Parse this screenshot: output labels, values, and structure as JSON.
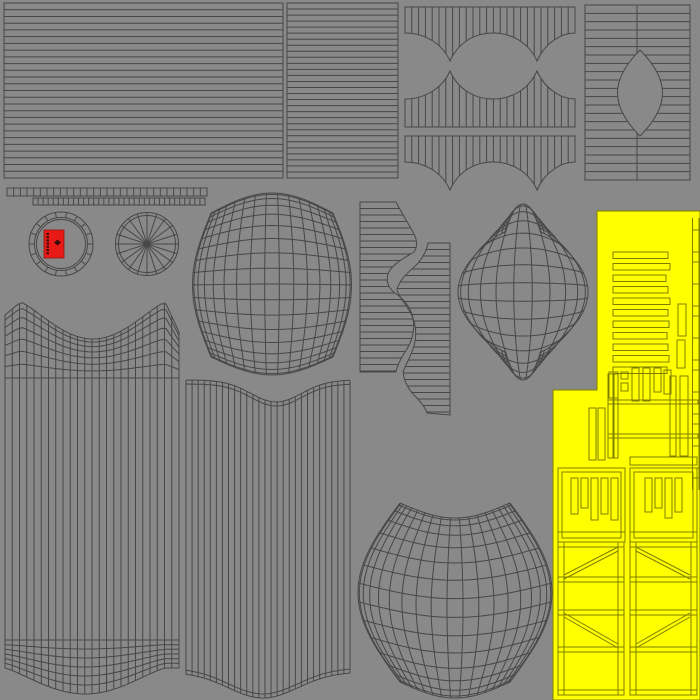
{
  "canvas": {
    "width": 700,
    "height": 700,
    "background": "#898989"
  },
  "palette": {
    "wire": "#474747",
    "yellow": "#ffff00",
    "yellow_wire": "#7f7f00",
    "red": "#e81a17",
    "red_dark": "#3a0b0b"
  },
  "red_label": {
    "x": 44,
    "y": 230,
    "w": 20,
    "h": 28,
    "dots": 7,
    "dot_x": 46.5,
    "dot_y0": 233,
    "dot_step": 3.2,
    "glyph_cx": 57.5,
    "glyph_cy": 242.5
  },
  "islands": [
    {
      "name": "panel-top-left-hlines",
      "kind": "hrect",
      "x": 4,
      "y": 3,
      "w": 279,
      "h": 175,
      "lines": 26
    },
    {
      "name": "panel-top-mid-hlines",
      "kind": "hrect",
      "x": 287,
      "y": 3,
      "w": 111,
      "h": 175,
      "lines": 29
    },
    {
      "name": "band-top",
      "kind": "path_hatch",
      "hatch": "v",
      "spacing": 6.8,
      "path": "M405,7 H575 V33 C561,33 545,43 537,61 C529,43 512,33 493,33 C474,33 458,43 450,61 C442,43 424,33 405,33 Z"
    },
    {
      "name": "band-middle",
      "kind": "path_hatch",
      "hatch": "v",
      "spacing": 6.8,
      "path": "M405,99 C424,99 442,89 450,71 C458,89 474,99 493,99 C512,99 529,89 537,71 C545,89 561,99 575,99 V127 H405 Z"
    },
    {
      "name": "band-bottom",
      "kind": "path_hatch",
      "hatch": "v",
      "spacing": 6.8,
      "path": "M405,136 H575 V162 C561,162 545,172 537,190 C529,172 512,162 493,162 C474,162 458,172 450,190 C442,172 424,162 405,162 Z"
    },
    {
      "name": "panel-top-right-lens",
      "kind": "hrect_hole",
      "x": 585,
      "y": 5,
      "w": 105,
      "h": 175,
      "lines": 21,
      "centerX": 637,
      "hole": {
        "cx": 640,
        "cy": 93,
        "rx": 30,
        "ry": 43
      }
    },
    {
      "name": "tick-strip-long",
      "kind": "tick_strip",
      "x": 7,
      "y": 188,
      "w": 200,
      "h": 8,
      "ticks": 30
    },
    {
      "name": "tick-strip-short",
      "kind": "tick_strip",
      "x": 33,
      "y": 198,
      "w": 172,
      "h": 7,
      "ticks": 34
    },
    {
      "name": "ring-island",
      "kind": "ring",
      "cx": 61,
      "cy": 244,
      "rOuter": 32,
      "rInner": 26.5,
      "segments": 18
    },
    {
      "name": "spoke-wheel-island",
      "kind": "wheel",
      "cx": 147,
      "cy": 244,
      "rOuter": 31.5,
      "rRim": 28.5,
      "spokes": 20
    },
    {
      "name": "barrel-grid",
      "kind": "pillow_grid",
      "cx": 272,
      "wEnd": 122,
      "wMid": 159,
      "yTop": 213,
      "yTopBulge": -20,
      "yBot": 357,
      "yBotBulge": 18,
      "cols": 17,
      "rows": 18,
      "wPow": 1,
      "yPow": 1
    },
    {
      "name": "zigzag-left",
      "kind": "path_hatch",
      "hatch": "h",
      "spacing": 6.5,
      "path": "M360,202 H396 C402,214 410,226 414,234 C417,240 418,246 414,252 C404,258 392,264 388,274 C386,281 388,288 395,293 C404,299 411,308 413,318 C415,330 412,342 405,352 C400,360 397,366 396,372 H360 Z"
    },
    {
      "name": "zigzag-right",
      "kind": "path_hatch",
      "hatch": "h",
      "spacing": 6.5,
      "path": "M428,243 C426,254 420,262 412,269 C404,276 398,283 397,290 C399,297 405,303 410,312 C416,322 417,334 414,346 C411,356 406,364 403,372 C404,381 408,389 415,396 C421,402 425,407 427,413 L450,415 V243 Z"
    },
    {
      "name": "pod-grid",
      "kind": "pillow_grid",
      "cx": 523,
      "wEnd": 36,
      "wMid": 130,
      "yTop": 232,
      "yTopBulge": -28,
      "yBot": 352,
      "yBotBulge": 28,
      "cols": 11,
      "rows": 15,
      "wPow": 0.8,
      "yPow": 0.7
    },
    {
      "name": "bowtie-skirt",
      "kind": "bowtie_skirt",
      "x0": 5,
      "x1": 179,
      "cols": 24,
      "peakY": 302,
      "dipAmp": 37,
      "midY": 378,
      "stripeEndY": 640,
      "botBase": 668,
      "botAmp": 26,
      "topRows": 7,
      "botRows": 6
    },
    {
      "name": "ribbon-band",
      "kind": "ribbon",
      "x0": 186,
      "x1": 350,
      "cols": 27,
      "topBase": 380,
      "topAmp": 22,
      "topCenter": 0.55,
      "topWidth": 0.22,
      "botBase": 672,
      "botAmp": 26,
      "botCenter": 0.47,
      "botWidth": 0.3
    },
    {
      "name": "pillow-grid",
      "kind": "pillow_grid",
      "cx": 455,
      "wEnd": 110,
      "wMid": 194,
      "yTop": 503,
      "yTopBulge": 15,
      "yBot": 682,
      "yBotBulge": 16,
      "cols": 19,
      "rows": 15,
      "wPow": 1,
      "yPow": 1
    }
  ],
  "yellow_region": {
    "name": "yellow-uv-sheet",
    "outline": "M597,211 H700 V700 H553 V390 H597 Z",
    "bars": [
      [
        613,
        252,
        55,
        6.5
      ],
      [
        613,
        263.5,
        57,
        6.5
      ],
      [
        613,
        275,
        53,
        6.5
      ],
      [
        613,
        286.5,
        55,
        6.5
      ],
      [
        613,
        298,
        57,
        6.5
      ],
      [
        613,
        309.5,
        55,
        6.5
      ],
      [
        613,
        321,
        56,
        6.5
      ],
      [
        613,
        332.5,
        54,
        6.5
      ],
      [
        613,
        344,
        55,
        6.5
      ],
      [
        613,
        355.5,
        56,
        6.5
      ],
      [
        613,
        367,
        54,
        6.5
      ]
    ],
    "rects": [
      [
        678,
        304,
        8,
        32
      ],
      [
        677,
        340,
        8,
        28
      ],
      [
        609,
        372,
        9,
        26
      ],
      [
        621,
        372,
        7,
        7
      ],
      [
        621,
        383,
        7,
        8
      ],
      [
        632,
        368,
        7,
        33
      ],
      [
        643,
        368,
        7,
        33
      ],
      [
        654,
        368,
        7,
        24
      ],
      [
        664,
        370,
        7,
        24
      ],
      [
        608,
        400,
        90,
        4
      ],
      [
        608,
        434,
        90,
        4
      ],
      [
        589,
        408,
        7,
        52
      ],
      [
        598,
        408,
        7,
        52
      ],
      [
        608,
        374,
        5,
        84
      ],
      [
        614,
        374,
        4,
        84
      ],
      [
        670,
        376,
        6,
        80
      ],
      [
        680,
        376,
        8,
        80
      ],
      [
        558,
        468,
        67,
        74
      ],
      [
        562,
        472,
        59,
        66
      ],
      [
        630,
        457,
        67,
        8
      ],
      [
        630,
        468,
        67,
        74
      ],
      [
        634,
        472,
        59,
        66
      ],
      [
        571,
        478,
        7,
        36
      ],
      [
        581,
        478,
        7,
        30
      ],
      [
        591,
        478,
        7,
        42
      ],
      [
        601,
        478,
        7,
        36
      ],
      [
        611,
        478,
        7,
        42
      ],
      [
        645,
        478,
        7,
        34
      ],
      [
        655,
        478,
        7,
        30
      ],
      [
        665,
        478,
        7,
        40
      ],
      [
        675,
        478,
        7,
        34
      ],
      [
        558,
        542,
        6,
        153
      ],
      [
        618,
        542,
        6,
        153
      ],
      [
        630,
        542,
        6,
        153
      ],
      [
        691,
        542,
        6,
        153
      ],
      [
        558,
        542,
        66,
        5
      ],
      [
        558,
        577,
        66,
        5
      ],
      [
        558,
        610,
        66,
        5
      ],
      [
        558,
        647,
        66,
        5
      ],
      [
        558,
        690,
        66,
        5
      ],
      [
        630,
        542,
        67,
        5
      ],
      [
        630,
        577,
        67,
        5
      ],
      [
        630,
        610,
        67,
        5
      ],
      [
        630,
        647,
        67,
        5
      ],
      [
        630,
        690,
        67,
        5
      ]
    ],
    "lines": [
      [
        692.5,
        218,
        692.5,
        490
      ],
      [
        699,
        218,
        699,
        490
      ],
      [
        692.5,
        230,
        699,
        230
      ],
      [
        692.5,
        252,
        699,
        252
      ],
      [
        692.5,
        262,
        699,
        262
      ],
      [
        692.5,
        284,
        699,
        284
      ],
      [
        692.5,
        306,
        699,
        306
      ],
      [
        692.5,
        316,
        699,
        316
      ],
      [
        692.5,
        338,
        699,
        338
      ],
      [
        692.5,
        360,
        699,
        360
      ],
      [
        692.5,
        370,
        699,
        370
      ],
      [
        692.5,
        392,
        699,
        392
      ],
      [
        692.5,
        414,
        699,
        414
      ],
      [
        692.5,
        424,
        699,
        424
      ],
      [
        692.5,
        446,
        699,
        446
      ],
      [
        692.5,
        468,
        699,
        468
      ],
      [
        692.5,
        478,
        699,
        478
      ],
      [
        558,
        532,
        625,
        532
      ],
      [
        630,
        532,
        697,
        532
      ],
      [
        564,
        575,
        618,
        547
      ],
      [
        564,
        579,
        618,
        551
      ],
      [
        564,
        613,
        618,
        644
      ],
      [
        564,
        617,
        618,
        648
      ],
      [
        636,
        547,
        690,
        575
      ],
      [
        636,
        551,
        690,
        579
      ],
      [
        636,
        644,
        690,
        613
      ],
      [
        636,
        648,
        690,
        617
      ]
    ]
  }
}
